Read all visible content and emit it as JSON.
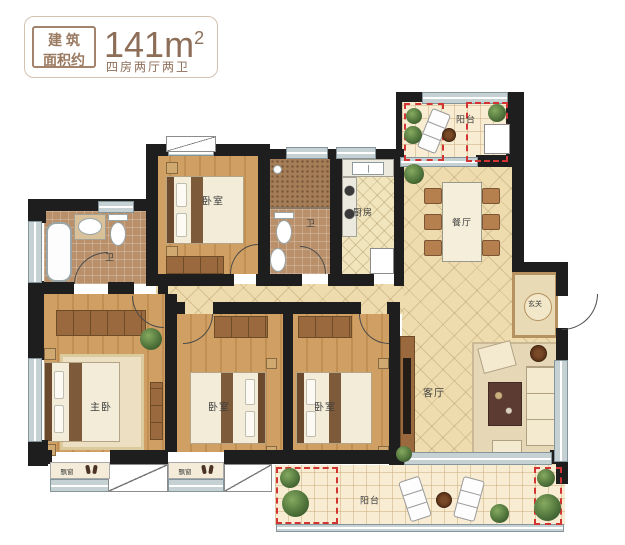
{
  "header": {
    "tag": {
      "line1": "建 筑",
      "line2": "面积约"
    },
    "area": "141m",
    "area_exp": "2",
    "subtitle": "四房两厅两卫"
  },
  "rooms": {
    "balcony_top": {
      "label": "阳台"
    },
    "dining": {
      "label": "餐厅"
    },
    "kitchen": {
      "label": "厨房"
    },
    "bath_mid": {
      "label": "卫"
    },
    "bedroom_top": {
      "label": "卧室"
    },
    "bath_left": {
      "label": "卫"
    },
    "master_bedroom": {
      "label": "主卧"
    },
    "bedroom_mid": {
      "label": "卧室"
    },
    "bedroom_right": {
      "label": "卧室"
    },
    "living_room": {
      "label": "客厅"
    },
    "foyer": {
      "label": "玄关"
    },
    "balcony_bottom": {
      "label": "阳台"
    },
    "bay_window_left": {
      "label": "飘窗"
    },
    "bay_window_mid": {
      "label": "飘窗"
    }
  },
  "colors": {
    "accent_text": "#8d6e58",
    "wall": "#1e1e1e",
    "window": "#c6d1d4",
    "wood_floor": "#c89a5a",
    "tile_floor": "#eedcae",
    "red_dashed": "#d23434"
  }
}
